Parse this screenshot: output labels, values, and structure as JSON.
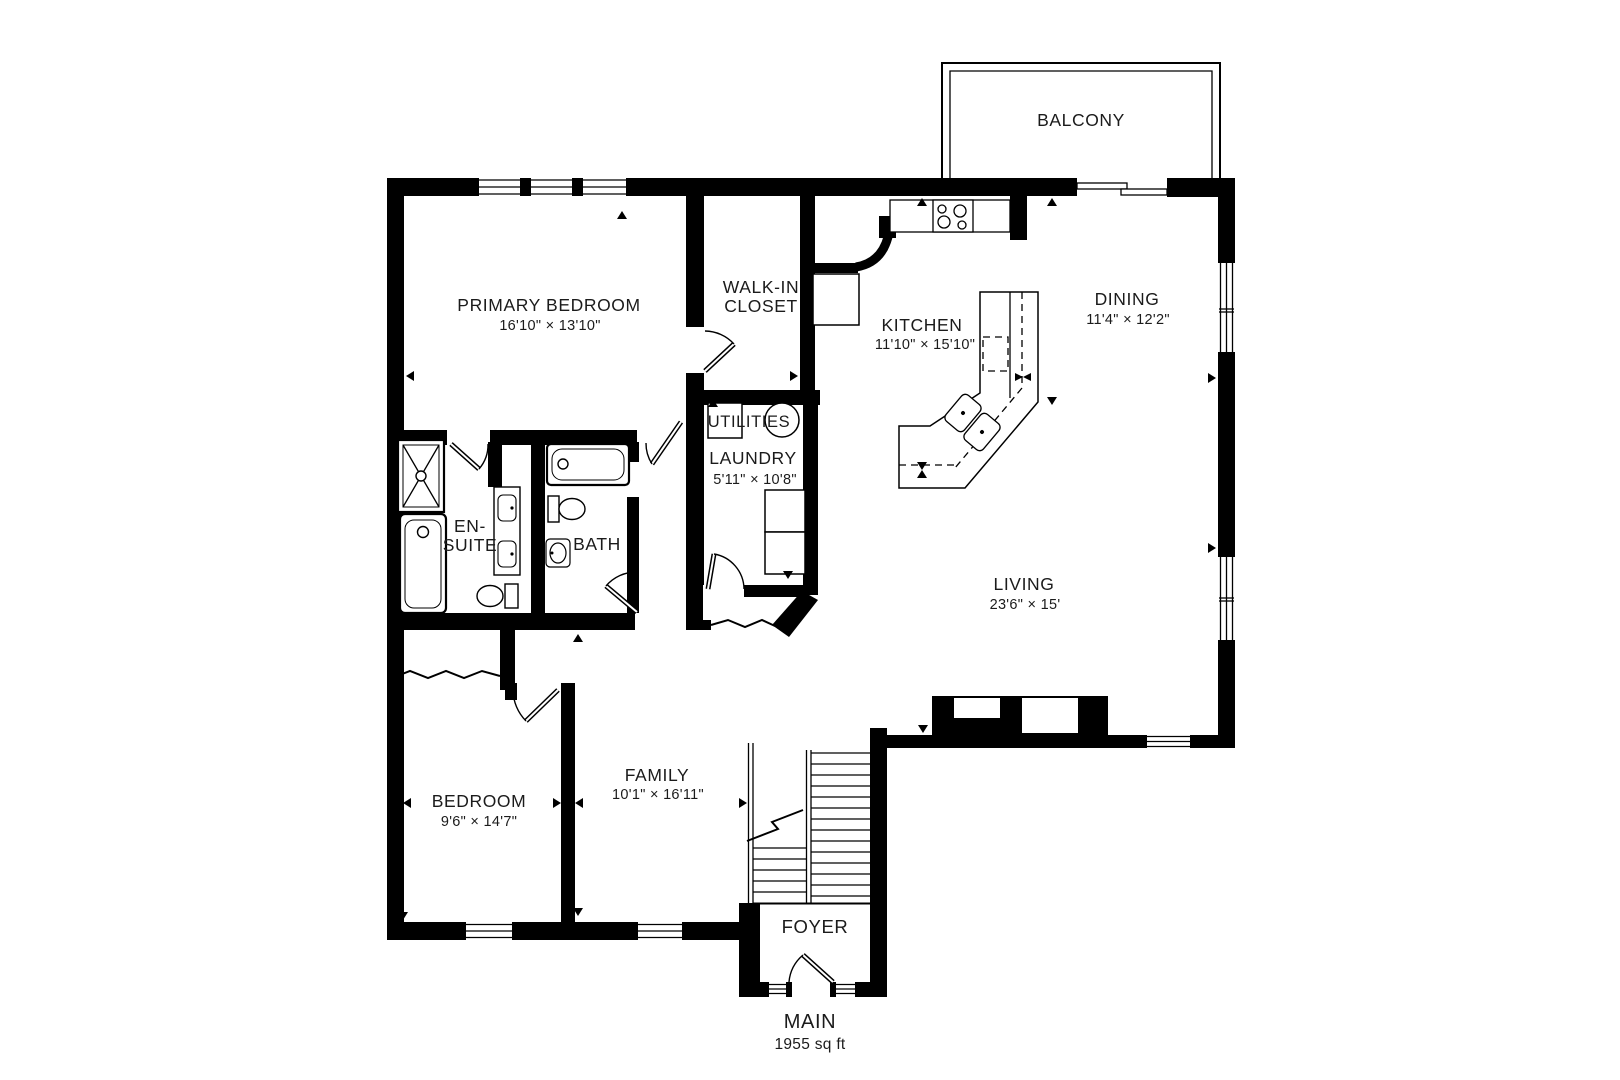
{
  "floorplan": {
    "title": "MAIN",
    "area": "1955 sq ft",
    "rooms": {
      "balcony": {
        "name": "BALCONY"
      },
      "primary_bedroom": {
        "name": "PRIMARY BEDROOM",
        "dims": "16'10\" × 13'10\""
      },
      "walk_in_closet": {
        "line1": "WALK-IN",
        "line2": "CLOSET"
      },
      "kitchen": {
        "name": "KITCHEN",
        "dims": "11'10\" × 15'10\""
      },
      "dining": {
        "name": "DINING",
        "dims": "11'4\" × 12'2\""
      },
      "utilities": {
        "name": "UTILITIES"
      },
      "laundry": {
        "name": "LAUNDRY",
        "dims": "5'11\" × 10'8\""
      },
      "ensuite": {
        "line1": "EN-",
        "line2": "SUITE"
      },
      "bath": {
        "name": "BATH"
      },
      "living": {
        "name": "LIVING",
        "dims": "23'6\" × 15'"
      },
      "bedroom": {
        "name": "BEDROOM",
        "dims": "9'6\" × 14'7\""
      },
      "family": {
        "name": "FAMILY",
        "dims": "10'1\" × 16'11\""
      },
      "foyer": {
        "name": "FOYER"
      }
    },
    "colors": {
      "wall": "#000000",
      "background": "#ffffff",
      "text": "#1b1b1b"
    }
  }
}
